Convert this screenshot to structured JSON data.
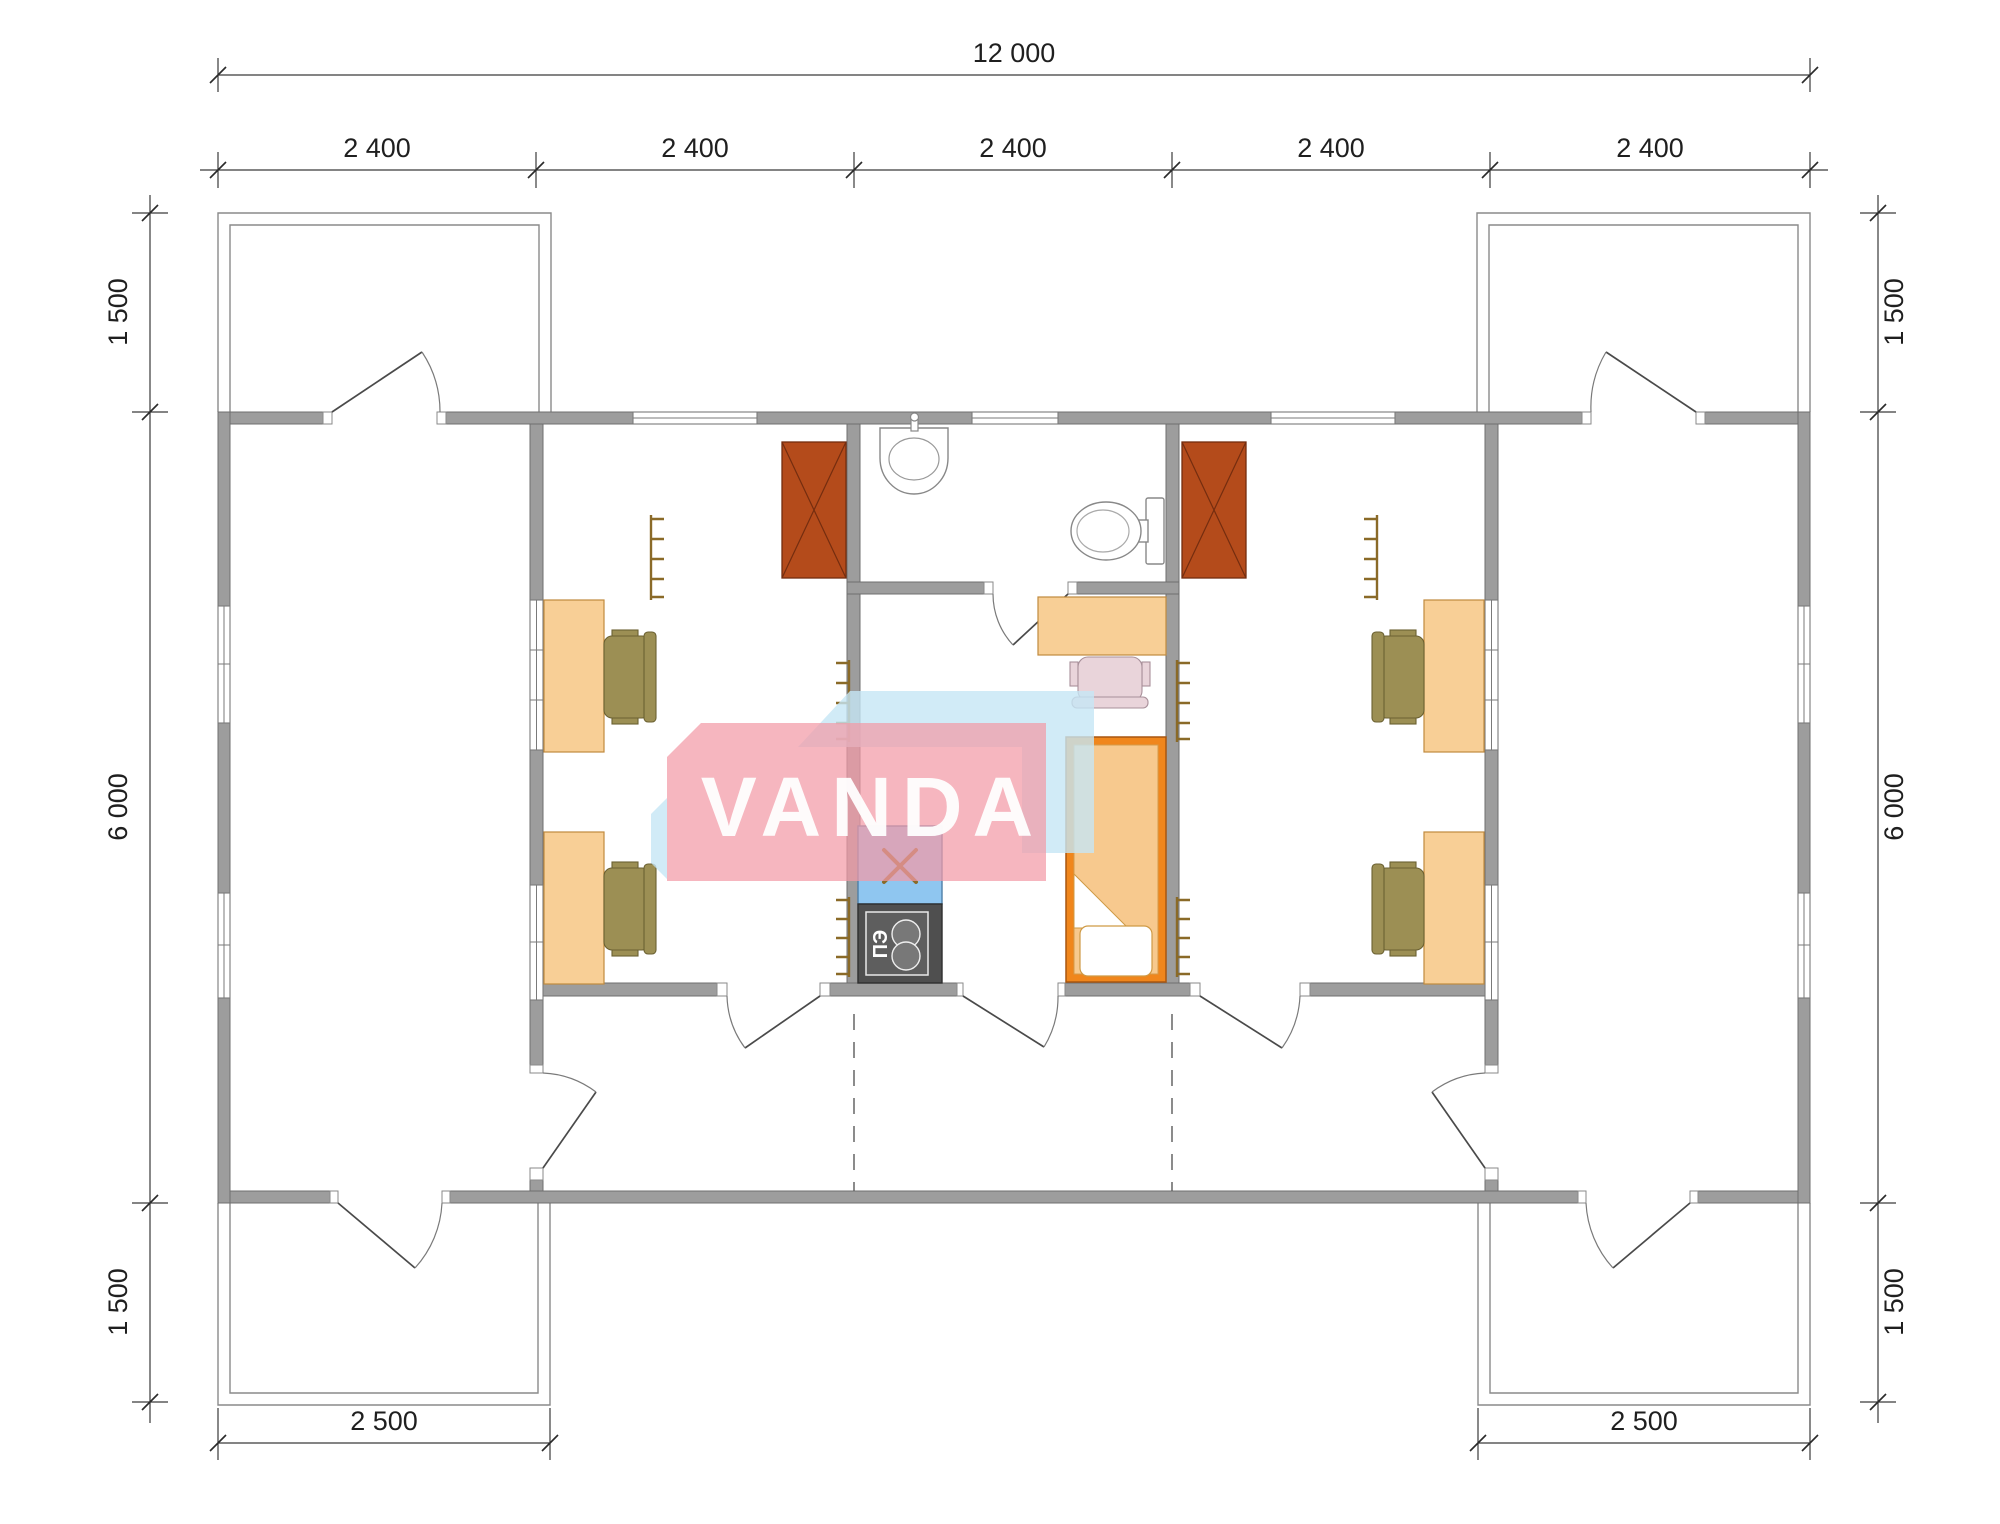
{
  "watermark": {
    "brand": "VANDA"
  },
  "appliance_labels": {
    "stove": "ПЭ"
  },
  "dimensions": {
    "overall_width": "12 000",
    "module_widths": [
      "2 400",
      "2 400",
      "2 400",
      "2 400",
      "2 400"
    ],
    "left_side": {
      "top": "1 500",
      "middle": "6 000",
      "bottom": "1 500"
    },
    "right_side": {
      "top": "1 500",
      "middle": "6 000",
      "bottom": "1 500"
    },
    "bottom_left_terrace": "2 500",
    "bottom_right_terrace": "2 500"
  },
  "rooms": {
    "center": [
      "bathroom with sink and toilet",
      "kitchen with sink and electric stove",
      "living area with bed and desk"
    ],
    "left_wing": [
      "office room with two desks",
      "empty veranda room with terrace access"
    ],
    "right_wing": [
      "office room with two desks",
      "empty veranda room with terrace access"
    ]
  },
  "furniture_icons": [
    "wardrobe-icon",
    "desk-icon",
    "office-chair-icon",
    "bed-icon",
    "kitchen-sink-icon",
    "electric-stove-icon",
    "bathroom-sink-icon",
    "toilet-icon",
    "radiator-icon",
    "door-swing-icon",
    "window-icon"
  ],
  "colors": {
    "wall": "#9D9D9D",
    "wall_outline": "#6F6F6F",
    "furniture_wood": "#F8CF96",
    "furniture_wood_border": "#C08A3E",
    "chair_olive": "#9C8F54",
    "chair_olive_border": "#6B6132",
    "chair_pink": "#E9D4DA",
    "wardrobe_rust": "#B44B1B",
    "bed_orange": "#F0861C",
    "mattress_peach": "#F7C98E",
    "kitchen_sink_blue": "#8FC6F0",
    "stove_gray": "#4F4F4F",
    "radiator_brown": "#8A6A28",
    "watermark_pink": "#F29AA6",
    "watermark_blue": "#C5E6F5",
    "dimension_text": "#1F1F1F"
  }
}
